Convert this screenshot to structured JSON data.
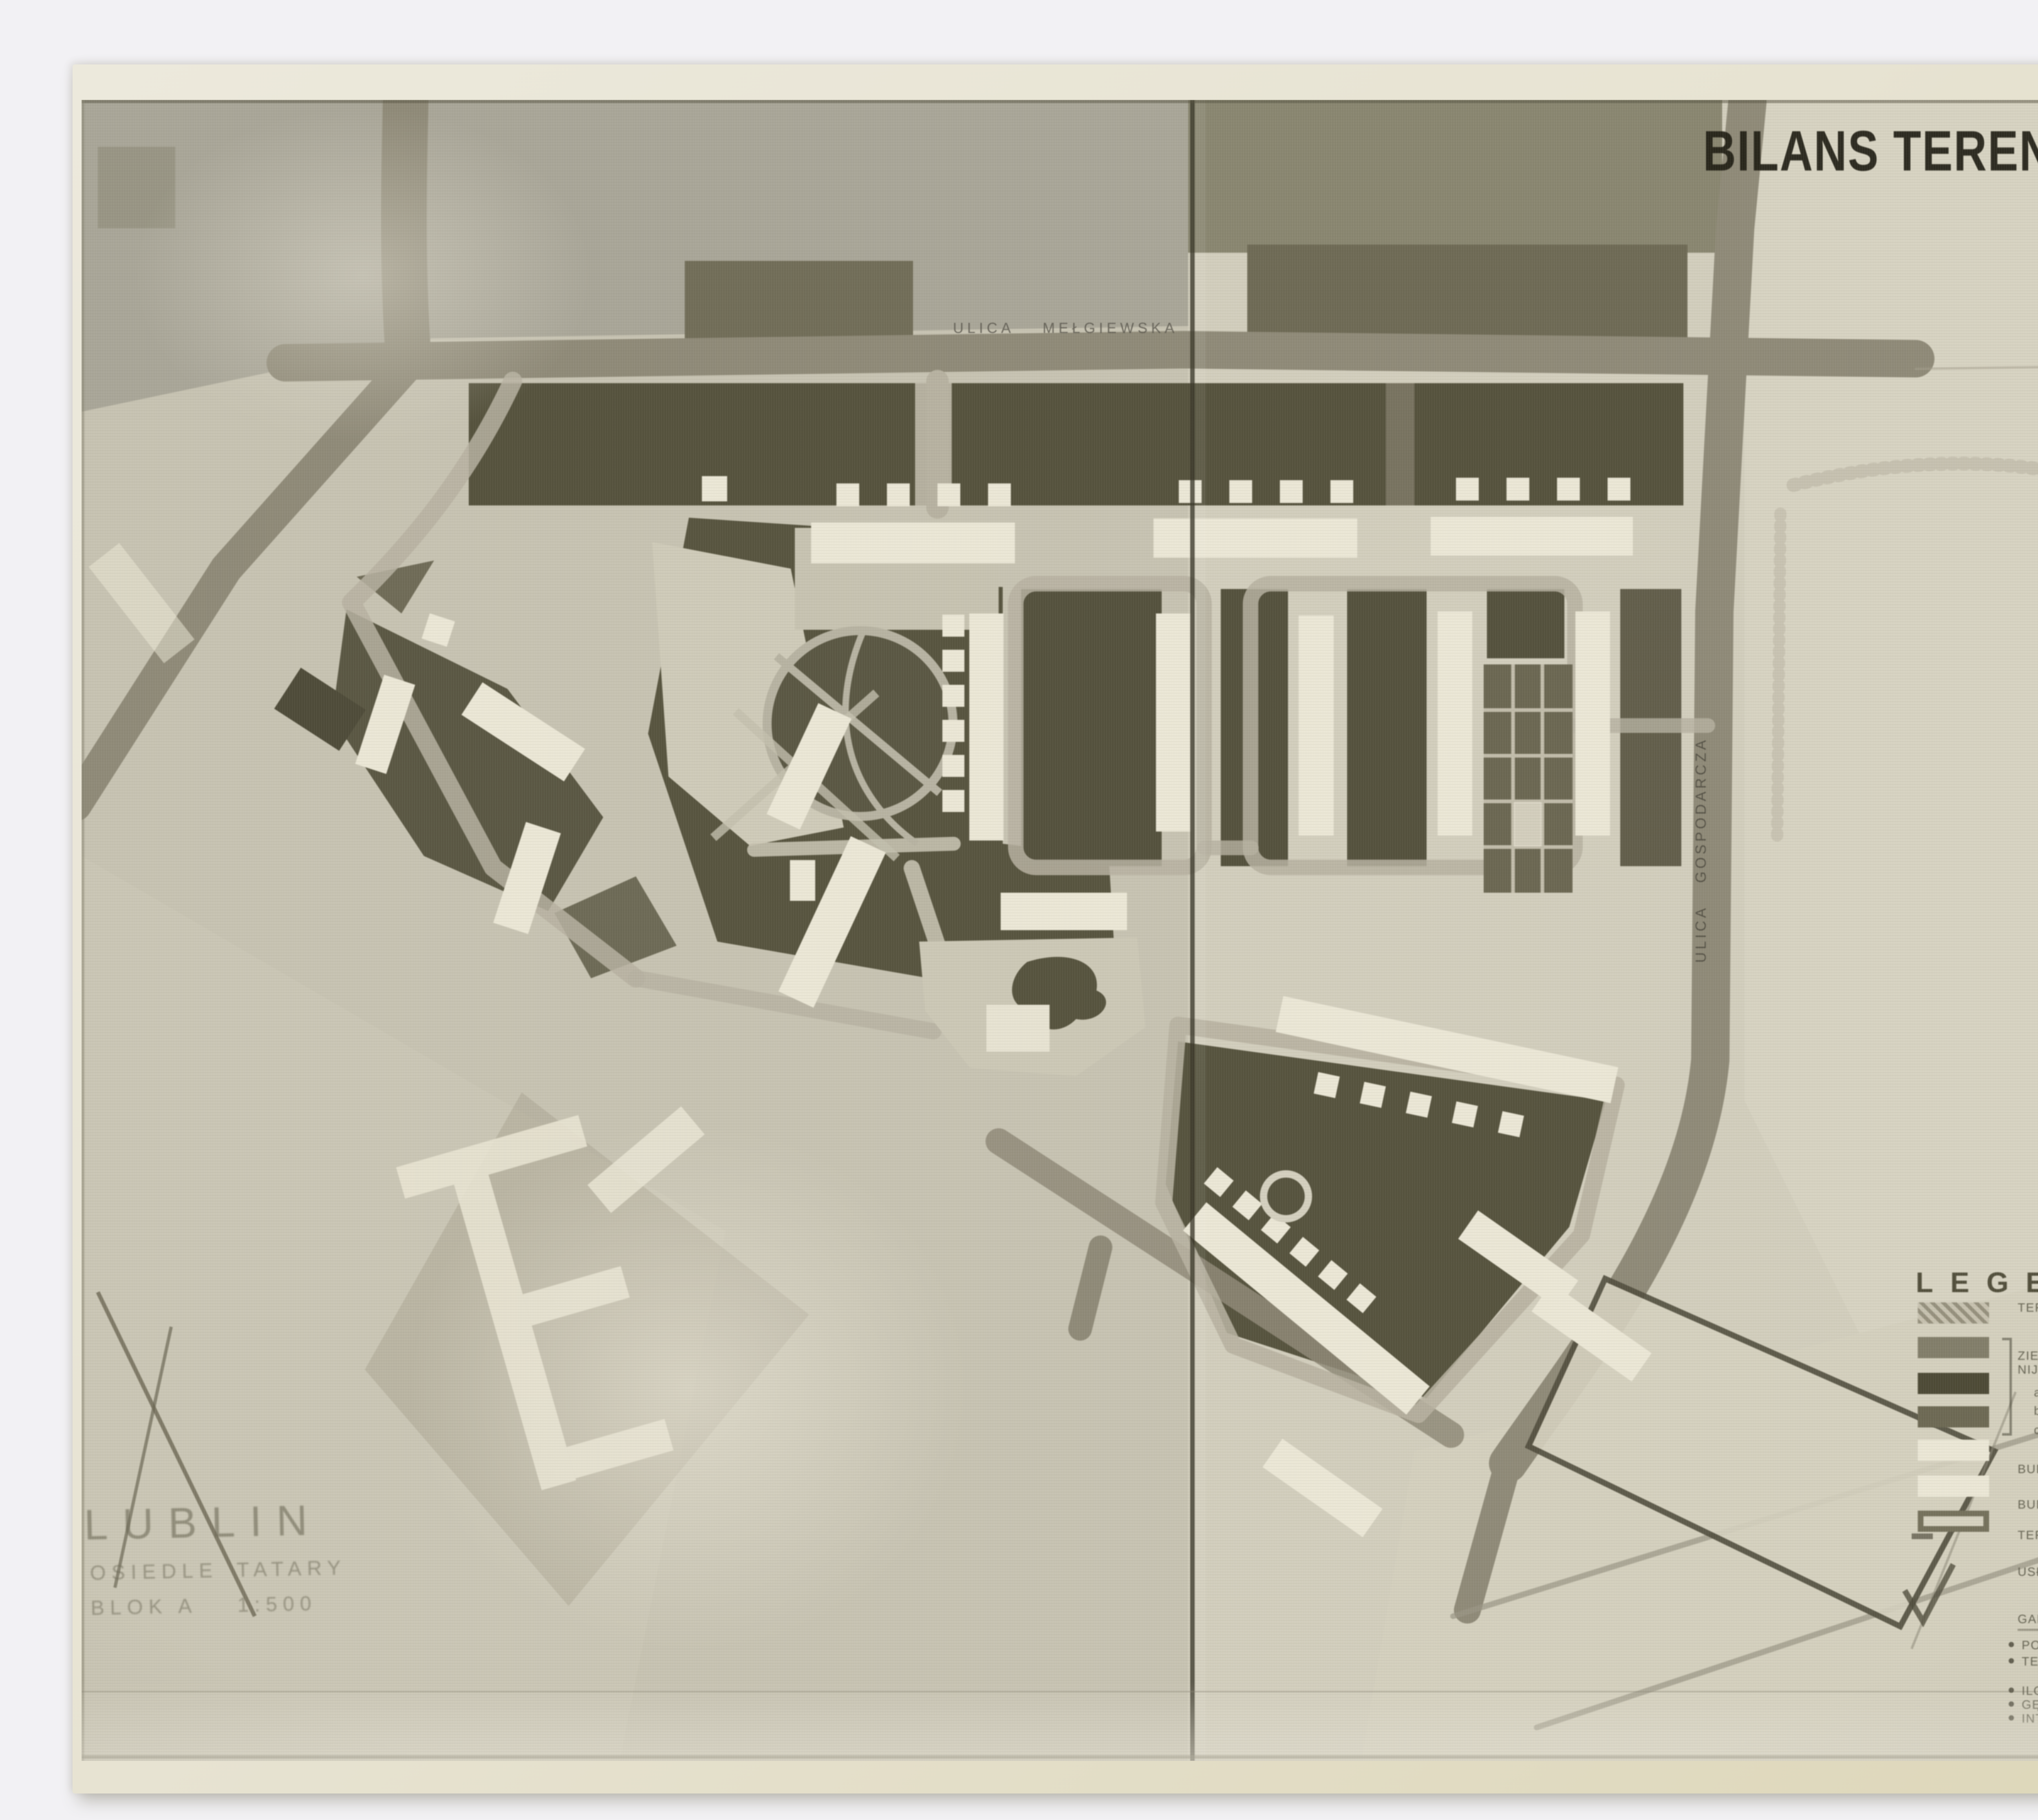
{
  "title": "BILANS TERENU i USŁUG",
  "streets": {
    "top": "ULICA MEŁGIEWSKA",
    "right": "ULICA GOSPODARCZA"
  },
  "caption": {
    "city": "LUBLIN",
    "estate_label": "OSIEDLE",
    "estate_name": "TATARY",
    "block_label": "BLOK A",
    "map_scale": "1:500"
  },
  "legend": {
    "heading": "LEGENDA :",
    "rows": [
      {
        "label": "TERENY OŚWIATY:",
        "v1": "SZKOŁA 1.97 ha",
        "v2": "PRZEDSZK. 0.40 ha",
        "sum": "2.37 ha"
      },
      {
        "label": "ZIELEŃ OSIEDLOWA KOLO-",
        "label2": "NIJNA I WEWNĄTRZBLOKOWA"
      },
      {
        "label": "a. TRAWNIKI",
        "value": "3.02 ha"
      },
      {
        "label": "b. ZIELEŃ NISKA",
        "value": "0.51 ha"
      },
      {
        "label": "c. ZIELEŃ WYSOKA",
        "value": "1.55 ha"
      },
      {
        "sum": "5.08 ha"
      },
      {
        "label": "BUDYNKI OŚWIATY – SZKOŁA",
        "value": "0.88 ha",
        "label2": "PRZEDSZK.",
        "value2": "0.28 ha"
      },
      {
        "label": "BUDYNKI MIESZKALNE",
        "value": "1.90 ha"
      },
      {
        "label": "TEREN POLIGONU DLA PREFABRYK.",
        "value": "0.92 ha"
      },
      {
        "label": "USŁUGI:",
        "c1": "HANDLOWE",
        "cv1": "0.06 ha",
        "c2": "ŻYWIENIE ZB.",
        "cv2": "0.03 ha",
        "c3": "RZEMIOSŁO",
        "cv3": "0.05 ha"
      },
      {
        "label": "GARAŻE",
        "value": "0.06 ha"
      }
    ],
    "summary": [
      {
        "label": "POWIERZCHNIA BLOKU (A)",
        "value": "5.70 ha"
      },
      {
        "label": "TEREN SZKOŁY",
        "value": "1.30 ha"
      },
      {
        "note": "RAZEM 7.00 ha"
      },
      {
        "label": "ILOŚĆ LUDNOŚCI W BLOKU (A)",
        "value": "7 000 M"
      },
      {
        "label": "GĘSTOŚĆ ZALUDNIENIA",
        "value": "587 M/HA"
      },
      {
        "label": "INTENSYWNOŚĆ ZABUDOWY",
        "value": "0.95"
      }
    ]
  },
  "colors": {
    "scan_background": "#f2f1f4",
    "photo_paper": "#e8e5d6",
    "print_base": "#c8c4b3",
    "road": "#8f8a78",
    "dark_green": "#55523d",
    "building": "#ebe7d6",
    "ink": "#211f15"
  }
}
